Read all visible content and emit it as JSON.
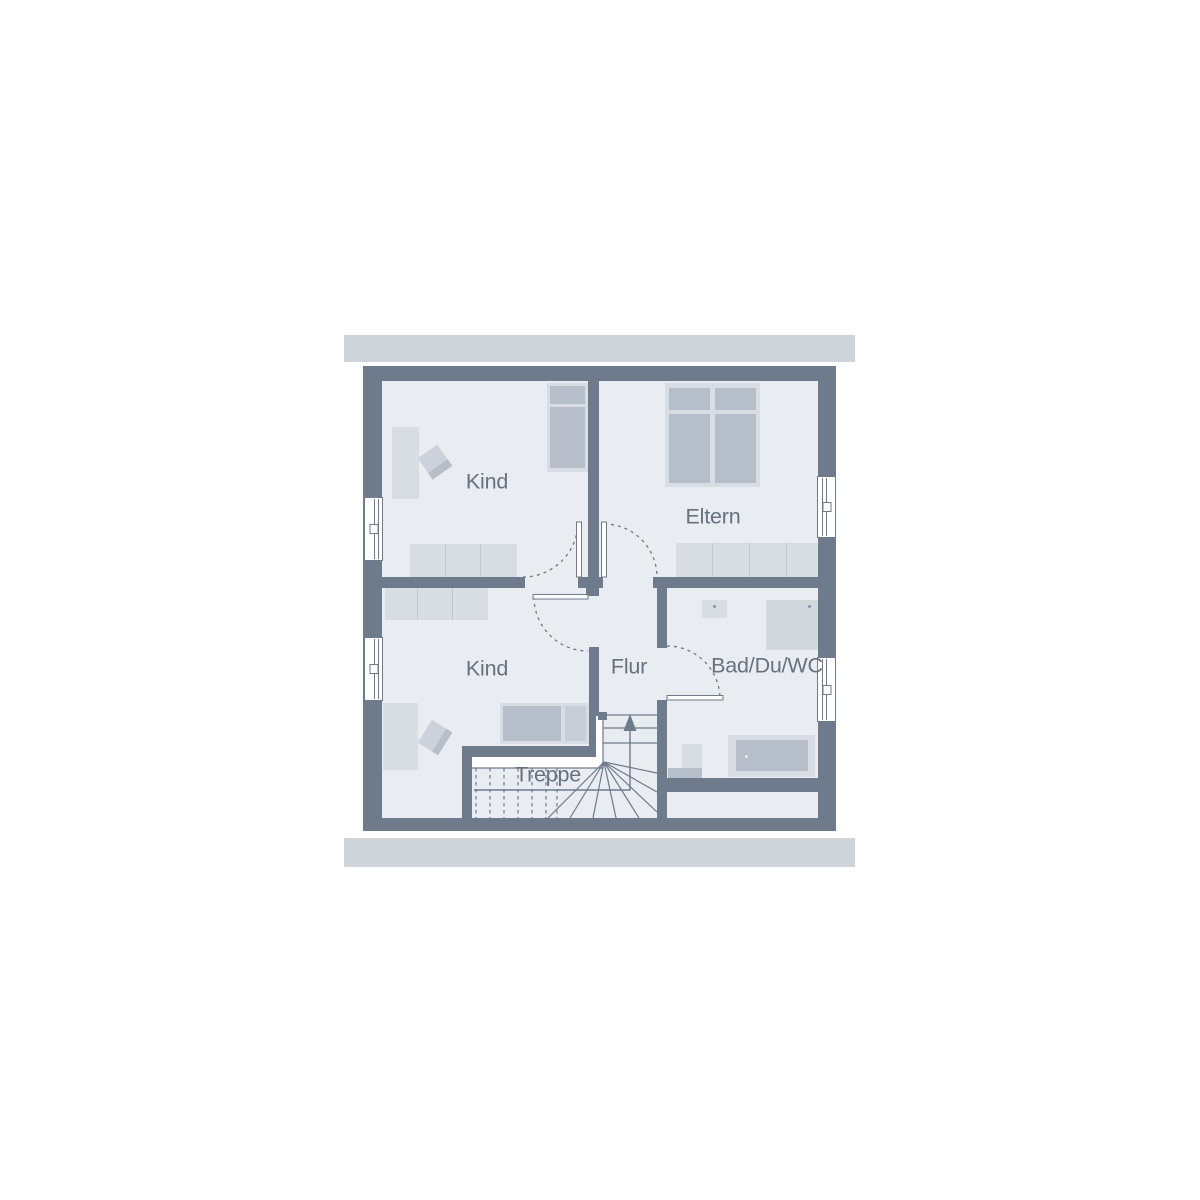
{
  "floorplan": {
    "rooms": [
      {
        "id": "kind-top",
        "label": "Kind"
      },
      {
        "id": "eltern",
        "label": "Eltern"
      },
      {
        "id": "kind-bottom",
        "label": "Kind"
      },
      {
        "id": "flur",
        "label": "Flur"
      },
      {
        "id": "bad-du-wc",
        "label": "Bad/Du/WC"
      },
      {
        "id": "treppe",
        "label": "Treppe"
      }
    ],
    "colors": {
      "wall": "#6d7b8c",
      "floor": "#e9ecf1",
      "furniture_light": "#d8dce3",
      "furniture_dark": "#b6bec9",
      "roof_band": "#cfd3da",
      "label_text": "#66727f",
      "window": "#ffffff"
    }
  }
}
